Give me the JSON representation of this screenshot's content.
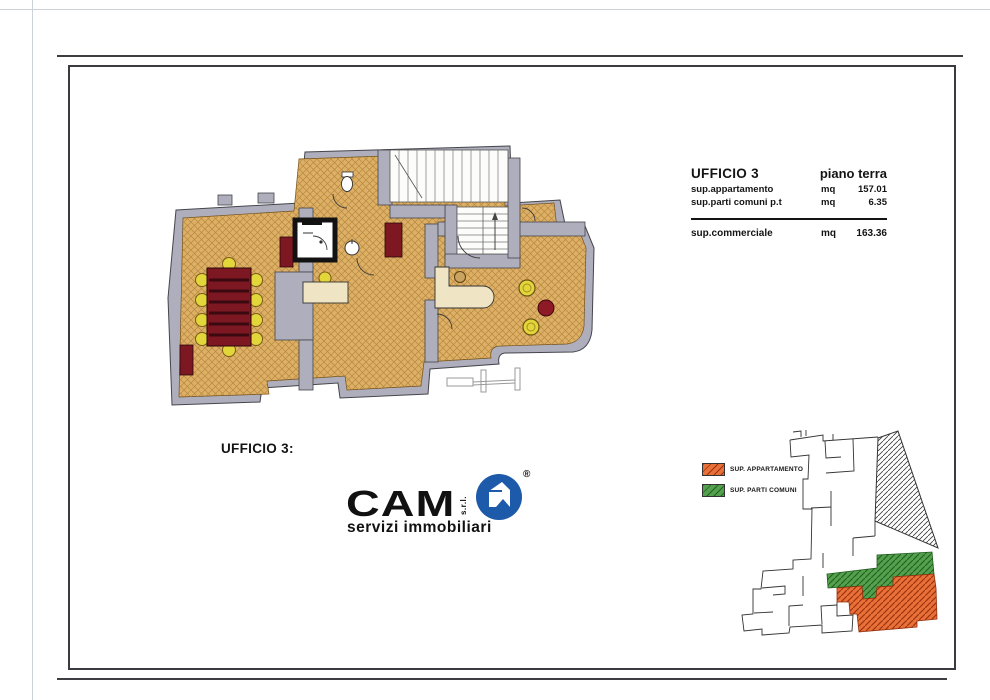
{
  "document": {
    "title_block": {
      "title": "UFFICIO 3",
      "floor": "piano terra",
      "rows": [
        {
          "label": "sup.appartamento",
          "unit": "mq",
          "value": "157.01"
        },
        {
          "label": "sup.parti comuni p.t",
          "unit": "mq",
          "value": "6.35"
        }
      ],
      "total_row": {
        "label": "sup.commerciale",
        "unit": "mq",
        "value": "163.36"
      }
    },
    "plan_caption": "UFFICIO 3:",
    "logo": {
      "name": "CAM",
      "suffix": "s.r.l.",
      "registered": "®",
      "tagline": "servizi immobiliari",
      "brand_blue": "#1d5aa9"
    },
    "legend": {
      "items": [
        {
          "label": "SUP. APPARTAMENTO",
          "color": "#e97038"
        },
        {
          "label": "SUP. PARTI COMUNI",
          "color": "#55a04f"
        }
      ]
    },
    "plan_colors": {
      "floor_tan": "#dcb066",
      "wall_gray": "#aeaebc",
      "accent_red": "#7d1722",
      "chair_yellow": "#e2d63b",
      "desk_cream": "#efe4c4"
    }
  }
}
